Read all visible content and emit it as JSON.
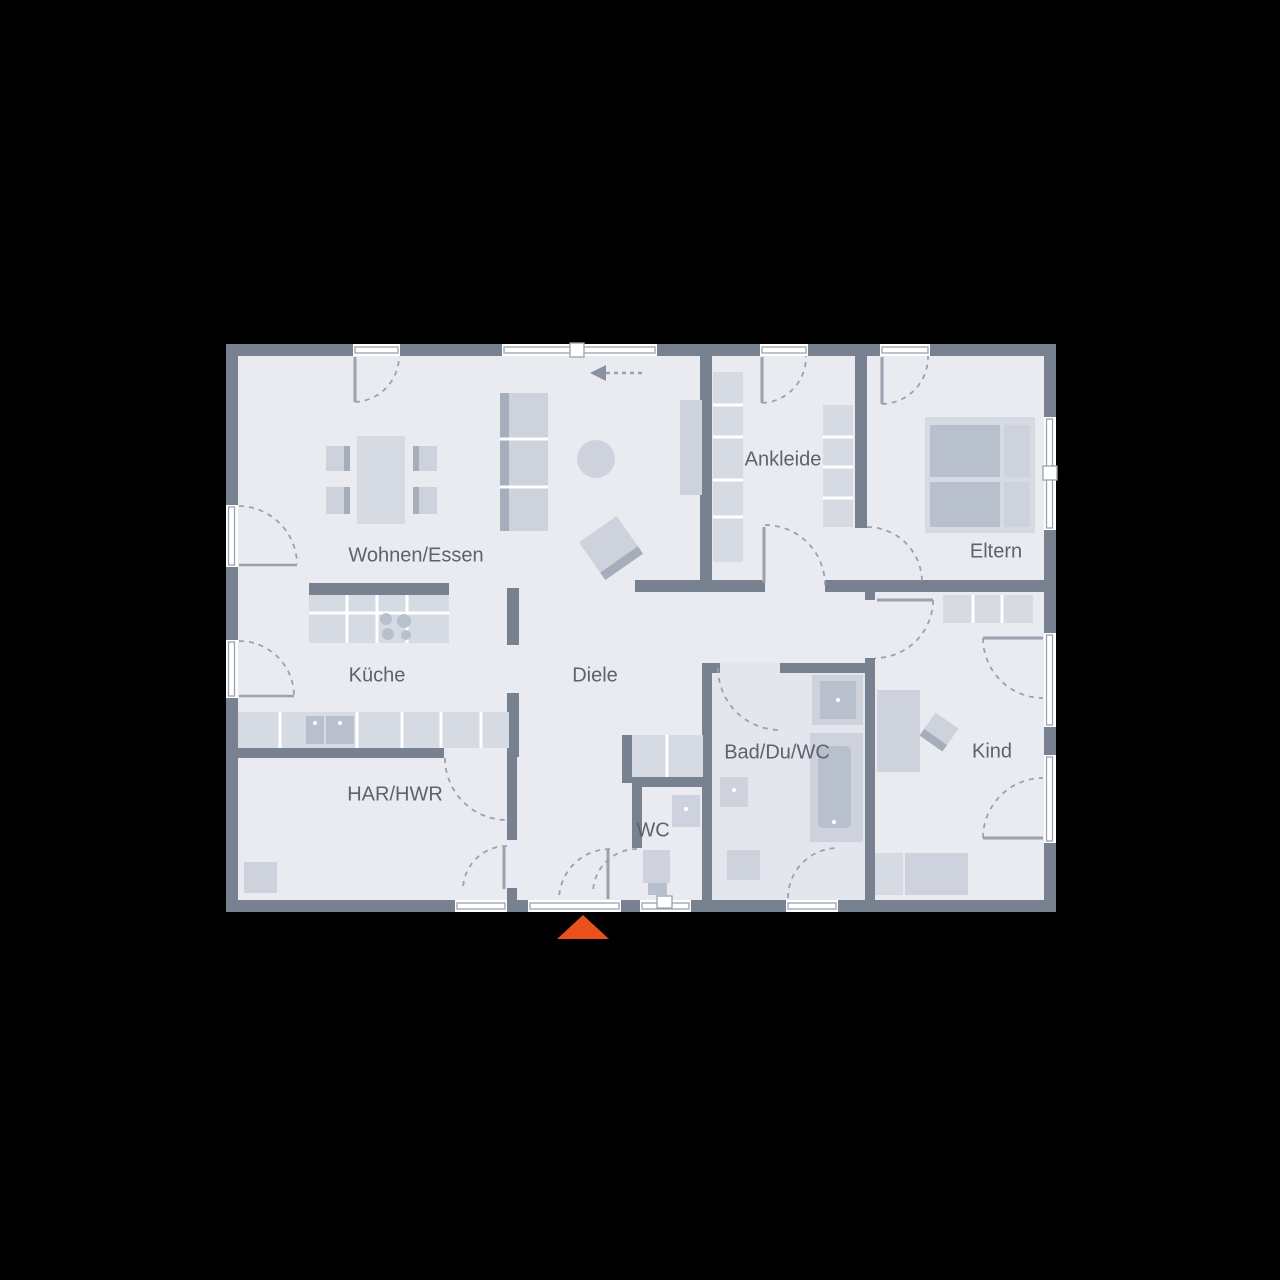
{
  "floorplan": {
    "rooms": [
      {
        "id": "wohnen-essen",
        "label": "Wohnen/Essen"
      },
      {
        "id": "kueche",
        "label": "Küche"
      },
      {
        "id": "diele",
        "label": "Diele"
      },
      {
        "id": "har-hwr",
        "label": "HAR/HWR"
      },
      {
        "id": "wc",
        "label": "WC"
      },
      {
        "id": "bad-du-wc",
        "label": "Bad/Du/WC"
      },
      {
        "id": "kind",
        "label": "Kind"
      },
      {
        "id": "ankleide",
        "label": "Ankleide"
      },
      {
        "id": "eltern",
        "label": "Eltern"
      }
    ],
    "icons": {
      "entrance_marker": "orange-triangle-up",
      "entry_direction": "dashed-arrow-left"
    },
    "colors": {
      "background": "#000000",
      "wall": "#78818f",
      "floor": "#e9ebf1",
      "floor_bath": "#e3e6ec",
      "furniture": "#cdd2dc",
      "furniture_light": "#d6dae2",
      "furniture_dark": "#b9c0cd",
      "furniture_edge": "#a6adbb",
      "outline": "#9aa2af",
      "label": "#5b6270",
      "accent": "#e8501c"
    }
  }
}
